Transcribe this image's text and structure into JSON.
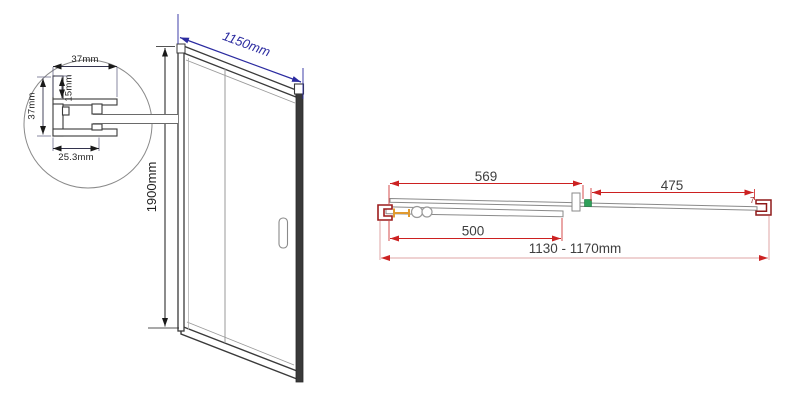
{
  "front_view": {
    "width_dim": "1150mm",
    "height_dim": "1900mm"
  },
  "detail_view": {
    "top_width_dim": "37mm",
    "inset_depth_dim": "15mm",
    "side_height_dim": "37mm",
    "bottom_width_dim": "25.3mm"
  },
  "plan_view": {
    "left_span_dim": "569",
    "right_span_dim": "475",
    "door_glass_dim": "500",
    "overall_width_dim": "1130 - 1170mm",
    "corner_mark": "7"
  },
  "colors": {
    "front_dim_accent": "#2b2ba0",
    "plan_dim_accent": "#cc2020",
    "plan_dim_light": "#dfa5a5",
    "bracket_dark_red": "#9c1c1c",
    "hardware_orange": "#e09a30",
    "connector_green": "#2fa05a",
    "frame_dark": "#3a3a3a",
    "line_gray": "#8a8a8a"
  }
}
